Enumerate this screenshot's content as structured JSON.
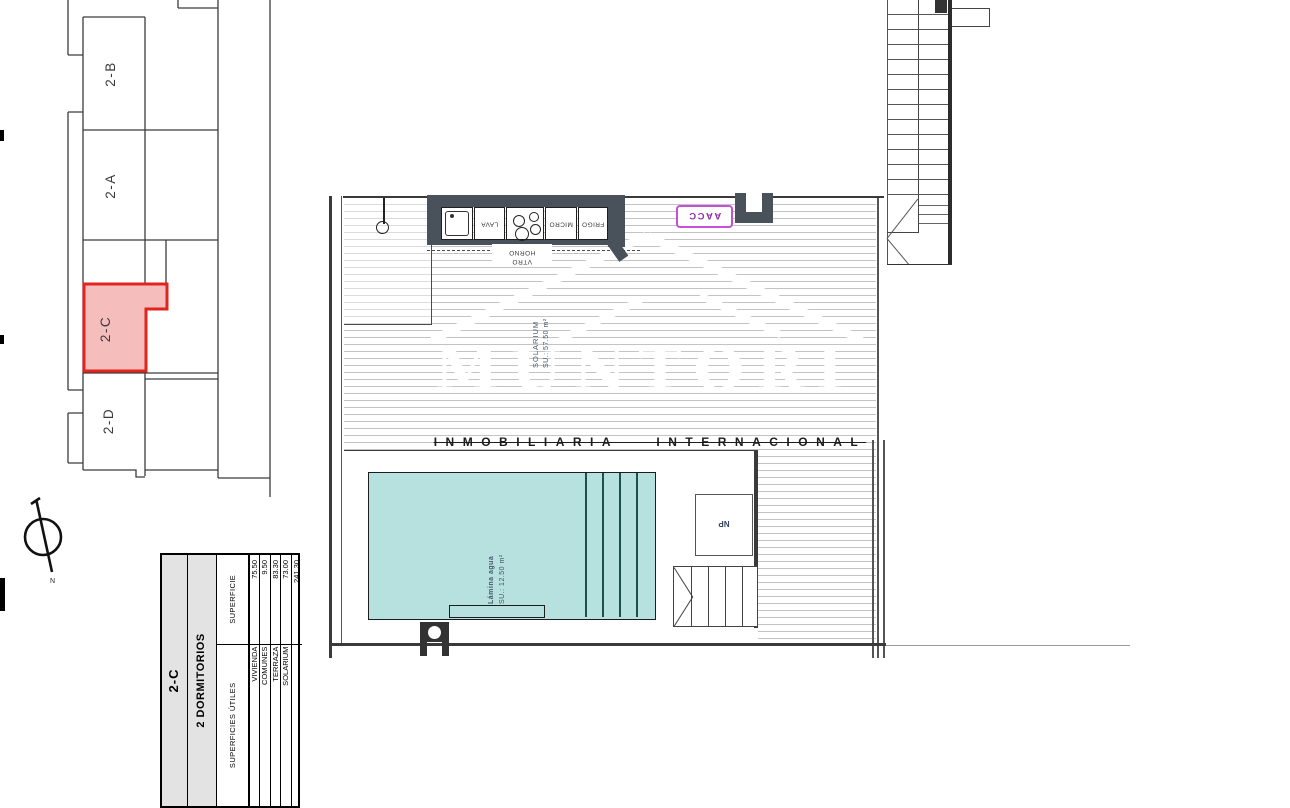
{
  "key_plan": {
    "units": [
      {
        "id": "2-B",
        "highlighted": false
      },
      {
        "id": "2-A",
        "highlighted": false
      },
      {
        "id": "2-C",
        "highlighted": true
      },
      {
        "id": "2-D",
        "highlighted": false
      }
    ],
    "north_label": "N"
  },
  "floor_plan": {
    "kitchen": {
      "appliance_labels": {
        "washer": "LAVA",
        "micro": "MICRO",
        "fridge": "FRIGO"
      },
      "dashed_labels": {
        "top": "HORNO",
        "bottom": "VTRO"
      }
    },
    "ac_label": "AACC",
    "solarium_label": {
      "name": "SOLARIUM",
      "area": "SU.: 57.50 m²"
    },
    "pool_label": {
      "name": "Lámina agua",
      "area": "SU.:  12.50 m²"
    },
    "np_label": "NP"
  },
  "watermark": {
    "brand": "MUNTORI",
    "subtitle": "INMOBILIARIA INTERNACIONAL"
  },
  "surface_table": {
    "unit": "2-C",
    "bedrooms": "2 DORMITORIOS",
    "header_left": "SUPERFICIES ÚTILES",
    "header_right": "SUPERFICIE",
    "rows": [
      {
        "label": "VIVIENDA",
        "value": "75.50"
      },
      {
        "label": "COMUNES",
        "value": "9.50"
      },
      {
        "label": "TERRAZA",
        "value": "83.30"
      },
      {
        "label": "SOLARIUM",
        "value": "73.00"
      },
      {
        "label": "",
        "value": "241.30"
      }
    ]
  },
  "colors": {
    "highlight_border": "#e0251f",
    "highlight_fill": "#f6bdbd",
    "pool_fill": "#b7e1de",
    "counter": "#49525b",
    "ac_border": "#c74fd6",
    "hatch_line": "#c3c3c3"
  }
}
